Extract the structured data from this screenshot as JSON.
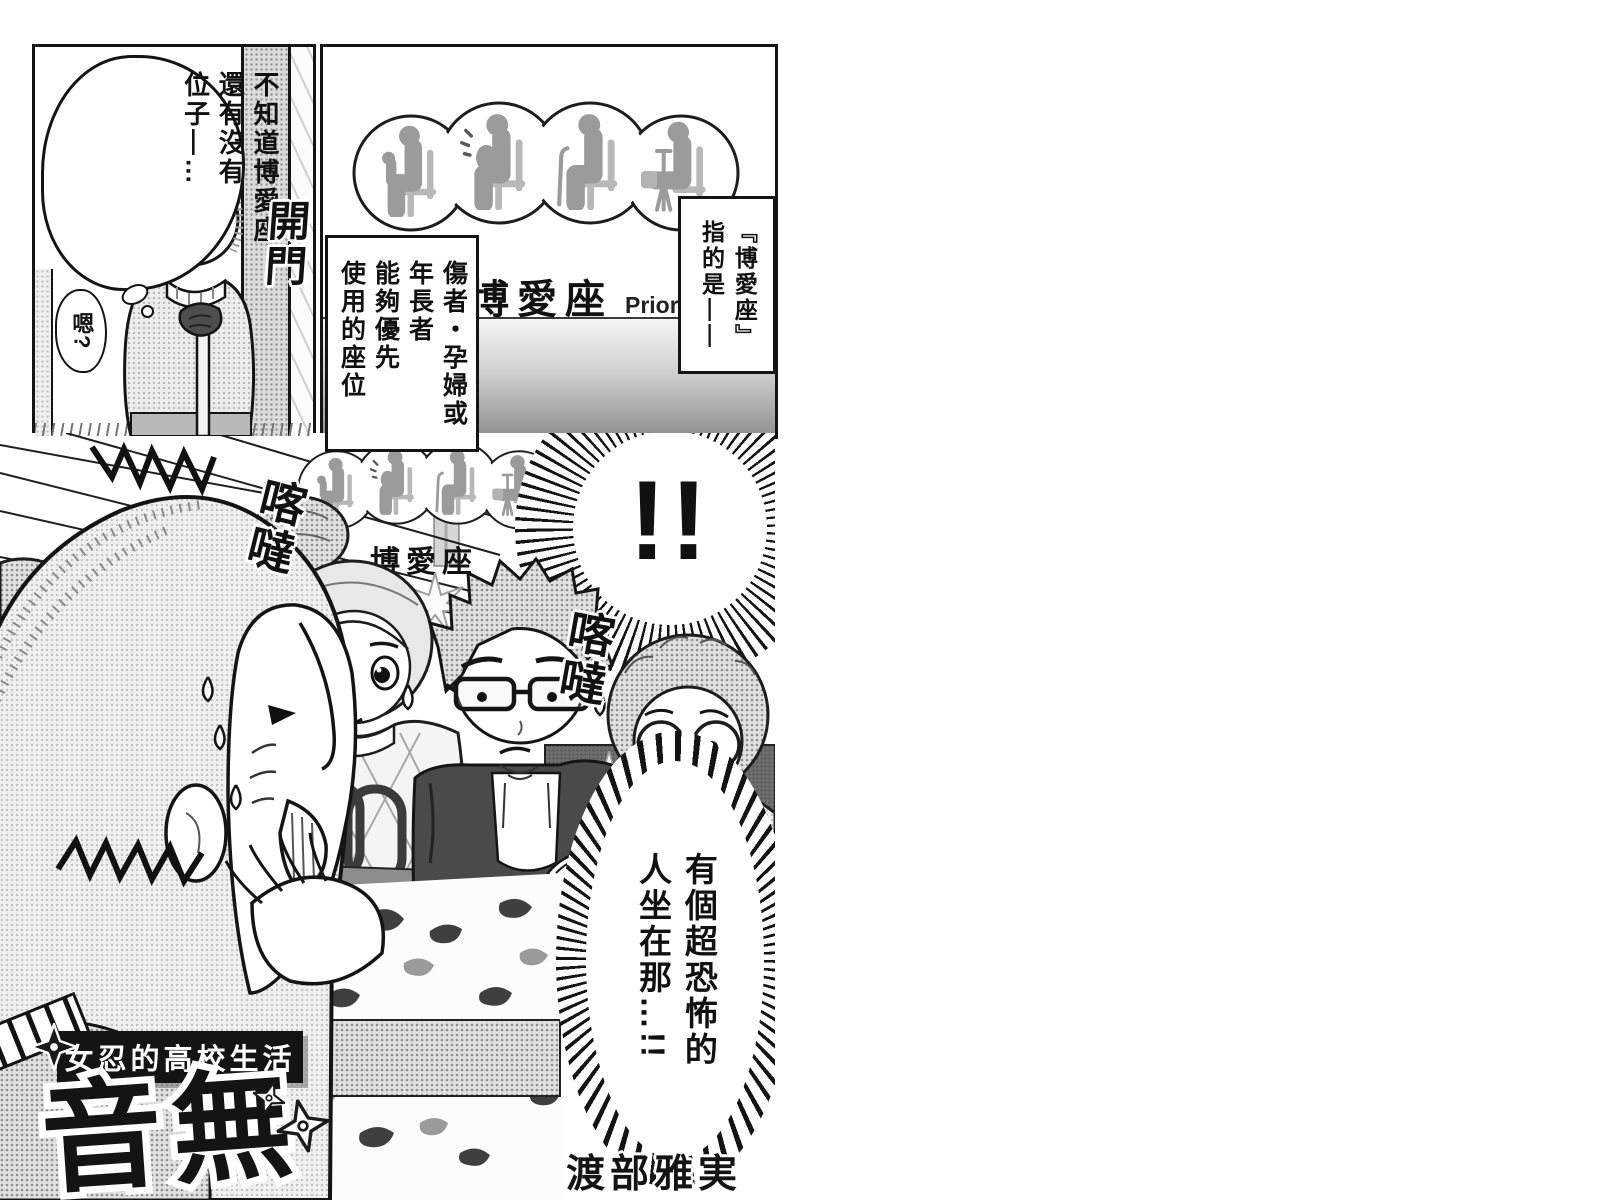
{
  "page": {
    "bg": "#ffffff",
    "ink": "#141414"
  },
  "panel1": {
    "thought": {
      "c1": "不知道博愛座",
      "c2": "還有沒有",
      "c3": "位子—…"
    },
    "murmur": "嗯?",
    "sfx_door": "開門"
  },
  "panel2": {
    "sign_zh": "博愛座",
    "sign_en": "Priority Seat",
    "caption_intro": {
      "c1": "『博愛座』",
      "c2": "指的是——"
    },
    "caption_desc": {
      "c1": "傷者・孕婦或",
      "c2": "年長者",
      "c3": "能夠優先",
      "c4": "使用的座位"
    }
  },
  "panel3": {
    "sfx_shock": "!!",
    "sfx_clack_left": "喀噠",
    "sfx_clack_right": "喀噠",
    "mini_sign_zh": "博愛座",
    "speech": {
      "c1": "有個超恐怖的",
      "c2": "人坐在那…!!"
    },
    "series_label": "女忍的高校生活",
    "logo": "音無",
    "author": "渡部雅実"
  },
  "icons": {
    "sign_pictograms": [
      "person-with-child",
      "pregnant-person",
      "person-with-cane",
      "person-with-crutch"
    ],
    "decorations": [
      "shuriken",
      "sparkle",
      "sweat-drop"
    ]
  }
}
